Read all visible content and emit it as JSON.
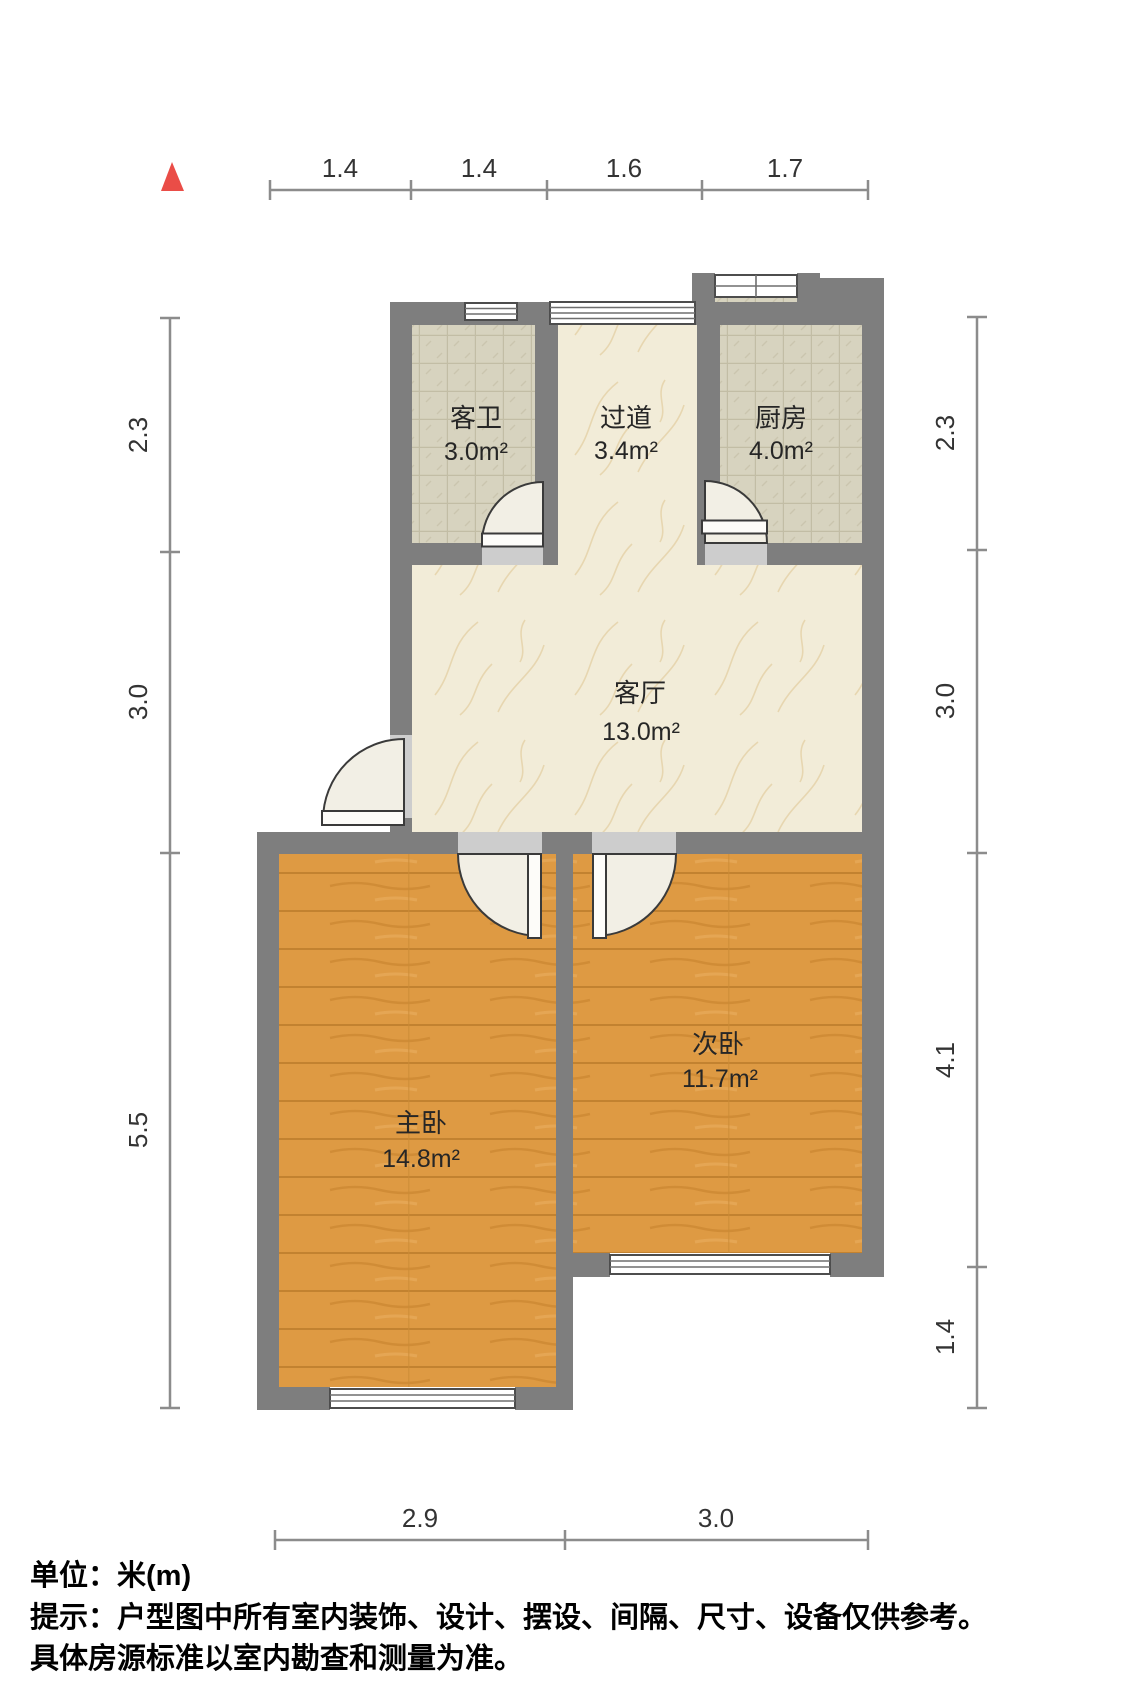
{
  "title": "户型图",
  "colors": {
    "wall": "#7e7e7e",
    "north_arrow": "#ea4d47",
    "wood_floor": "#de9a43",
    "tile_floor": "#d7d3bf",
    "marble_floor": "#f2ecd8",
    "ruler": "#8c8c8c"
  },
  "north_arrow": {
    "icon": "north-triangle"
  },
  "rooms": [
    {
      "id": "bathroom",
      "name": "客卫",
      "area": "3.0m²"
    },
    {
      "id": "hallway",
      "name": "过道",
      "area": "3.4m²"
    },
    {
      "id": "kitchen",
      "name": "厨房",
      "area": "4.0m²"
    },
    {
      "id": "living",
      "name": "客厅",
      "area": "13.0m²"
    },
    {
      "id": "master",
      "name": "主卧",
      "area": "14.8m²"
    },
    {
      "id": "second",
      "name": "次卧",
      "area": "11.7m²"
    }
  ],
  "rulers": {
    "top": [
      "1.4",
      "1.4",
      "1.6",
      "1.7"
    ],
    "left": [
      "2.3",
      "3.0",
      "5.5"
    ],
    "right": [
      "2.3",
      "3.0",
      "4.1",
      "1.4"
    ],
    "bottom": [
      "2.9",
      "3.0"
    ]
  },
  "footer": {
    "unit": "单位：米(m)",
    "notice1": "提示：户型图中所有室内装饰、设计、摆设、间隔、尺寸、设备仅供参考。",
    "notice2": "具体房源标准以室内勘查和测量为准。"
  }
}
